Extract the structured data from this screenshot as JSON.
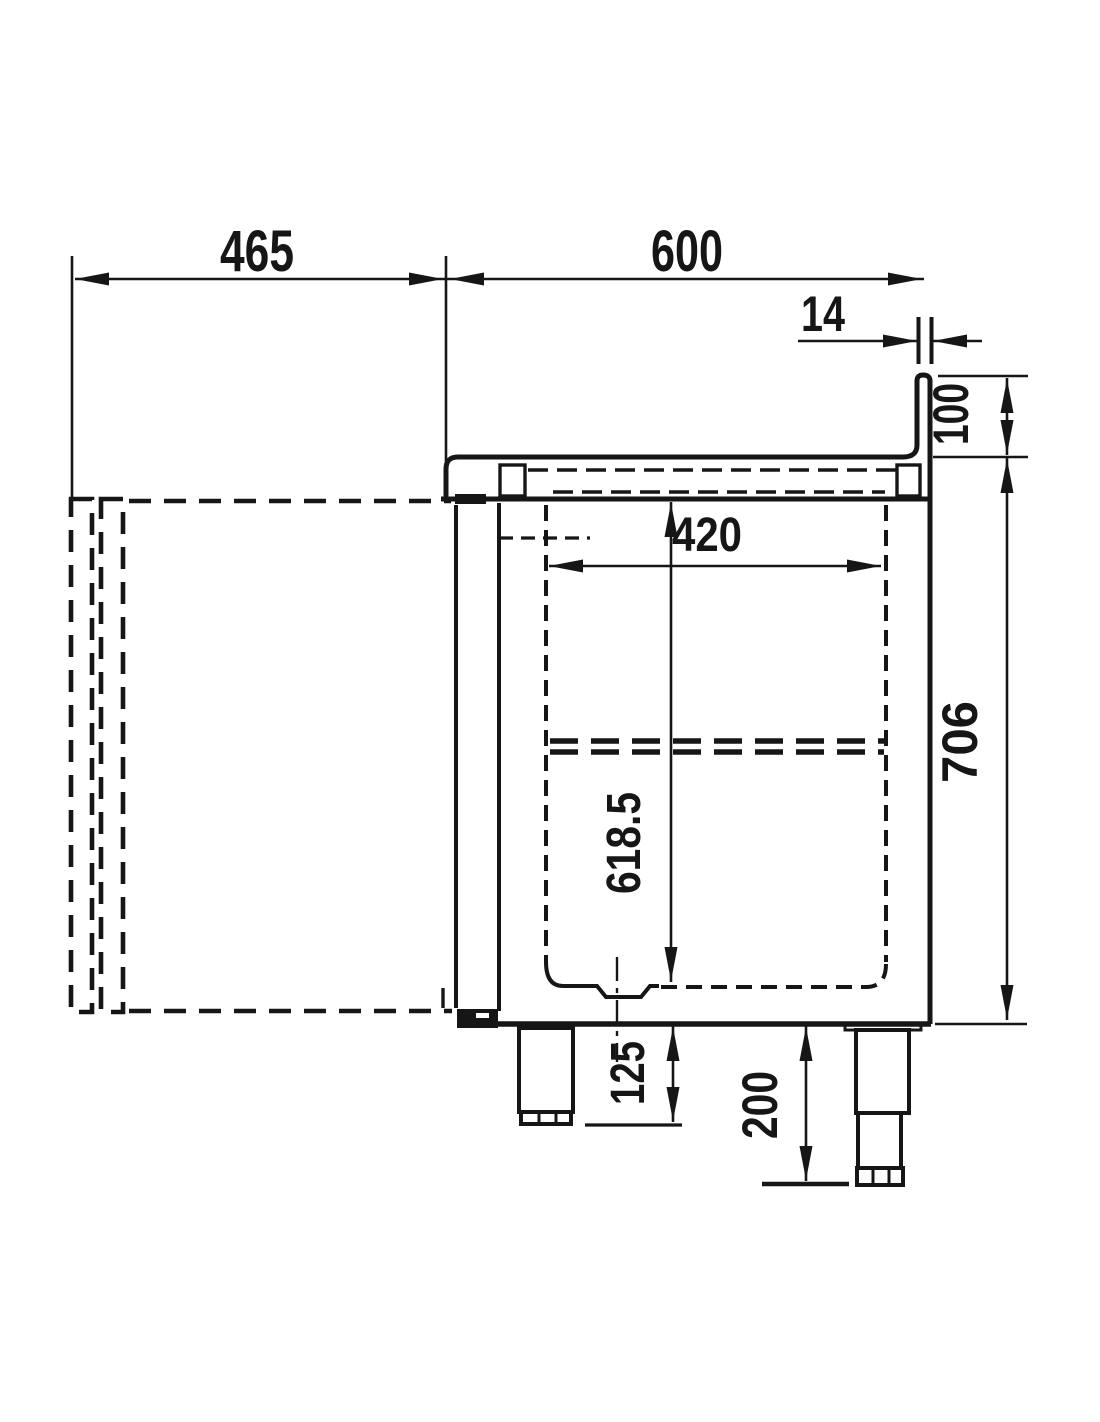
{
  "drawing": {
    "kind": "technical-dimension-drawing",
    "view": "side-section-of-refrigerated-counter",
    "background_color": "#ffffff",
    "line_color": "#161616",
    "units": "mm",
    "dims": {
      "d465": "465",
      "d600": "600",
      "d14": "14",
      "d100": "100",
      "d420": "420",
      "d706": "706",
      "d618_5": "618.5",
      "d125": "125",
      "d200": "200"
    }
  }
}
